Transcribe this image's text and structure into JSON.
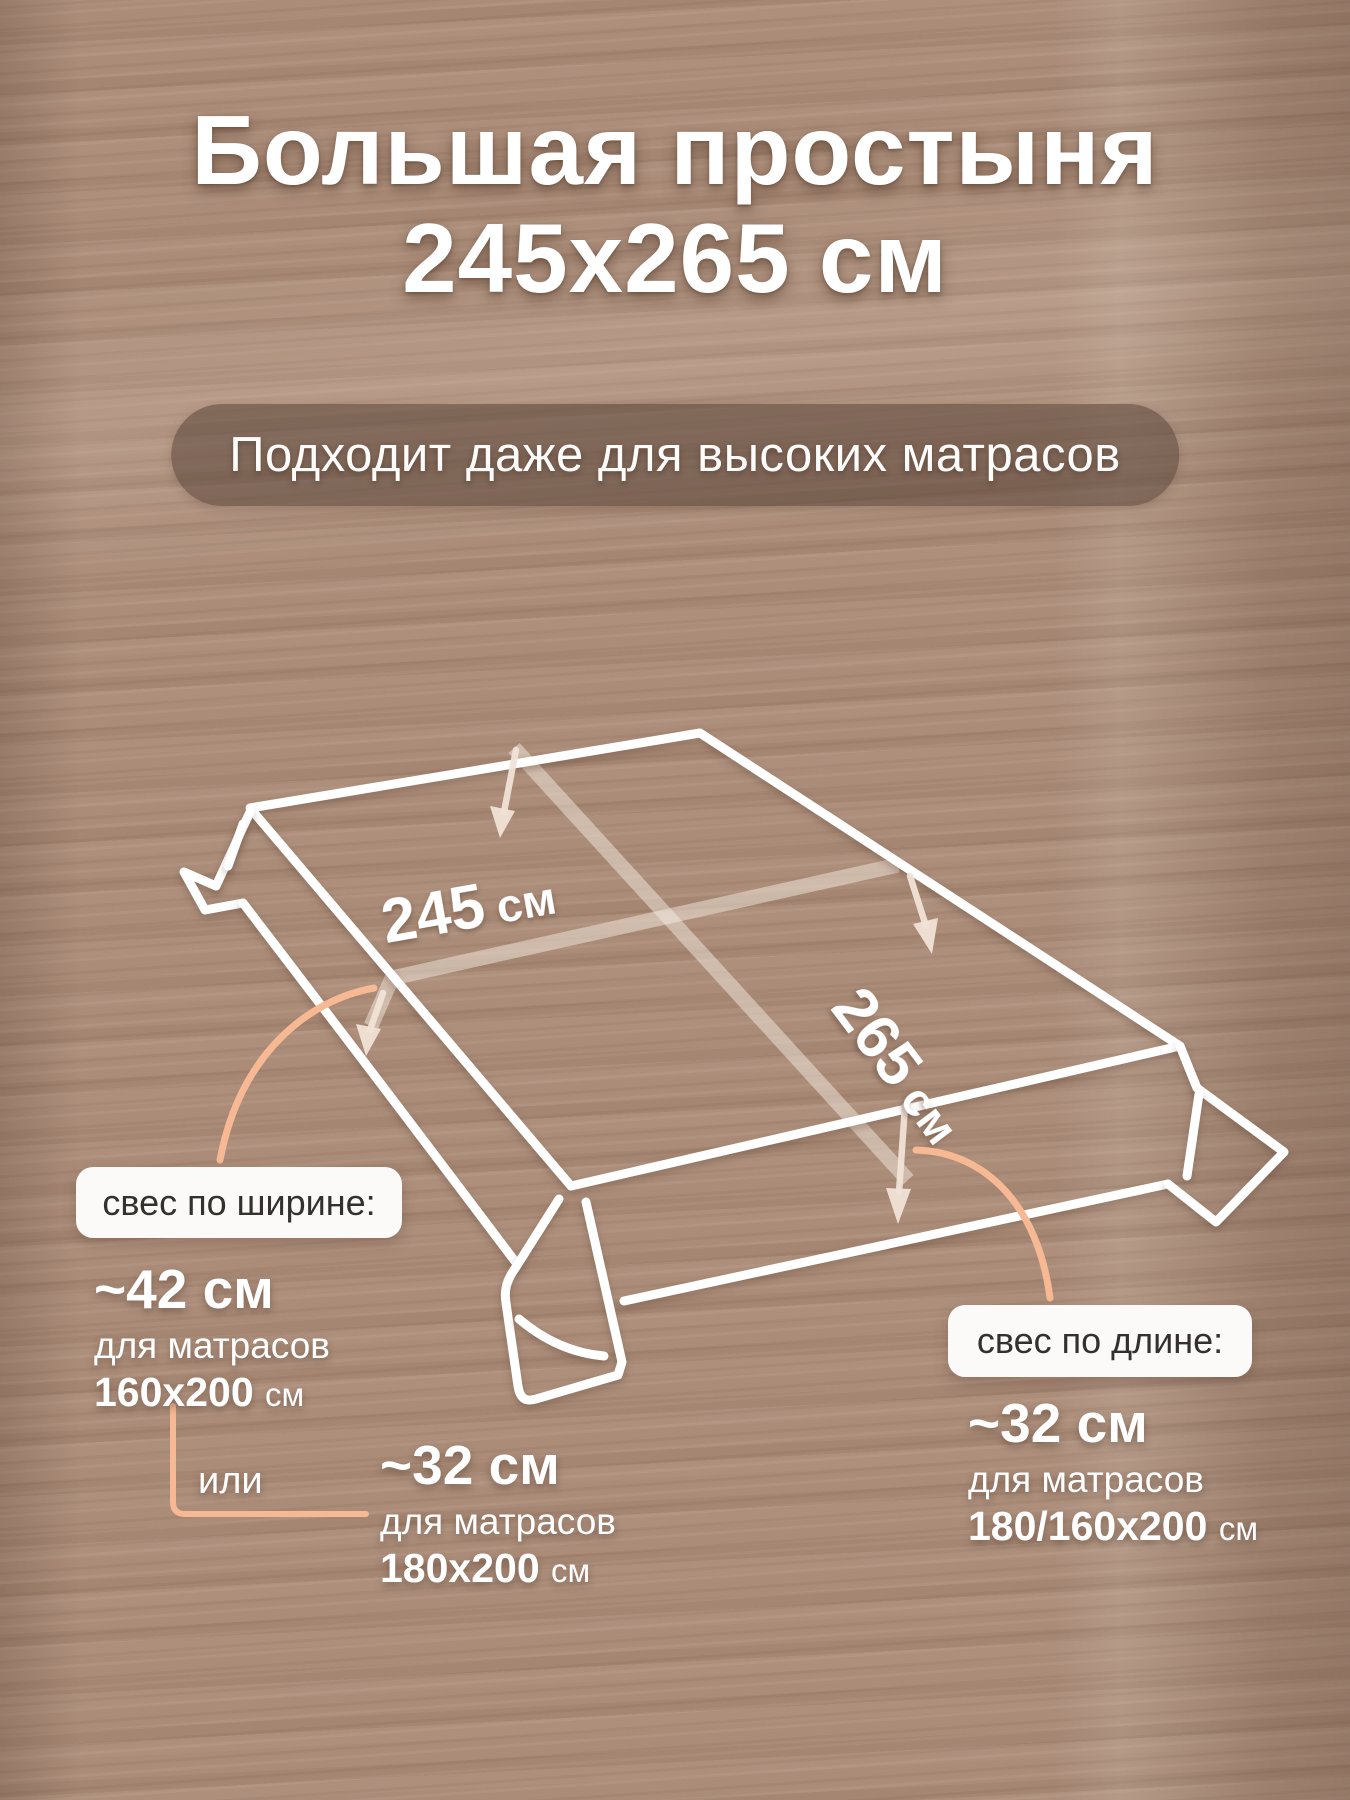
{
  "header": {
    "title_line1": "Большая простыня",
    "title_line2": "245х265 см",
    "badge": "Подходит даже для высоких матрасов"
  },
  "diagram": {
    "width": {
      "value": "245",
      "unit": "см"
    },
    "length": {
      "value": "265",
      "unit": "см"
    }
  },
  "overhang_width": {
    "title": "свес по ширине:",
    "option1": {
      "value": "~42 см",
      "for_text": "для матрасов",
      "size": "160х200",
      "unit": "см"
    },
    "separator": "или",
    "option2": {
      "value": "~32 см",
      "for_text": "для матрасов",
      "size": "180х200",
      "unit": "см"
    }
  },
  "overhang_length": {
    "title": "свес по длине:",
    "option": {
      "value": "~32 см",
      "for_text": "для матрасов",
      "size": "180/160х200",
      "unit": "см"
    }
  },
  "colors": {
    "background_brown": "#a98a76",
    "badge_brown": "#584439",
    "accent_peach": "#f6b993",
    "line_white": "#ffffff",
    "callout_text": "#34302d"
  }
}
